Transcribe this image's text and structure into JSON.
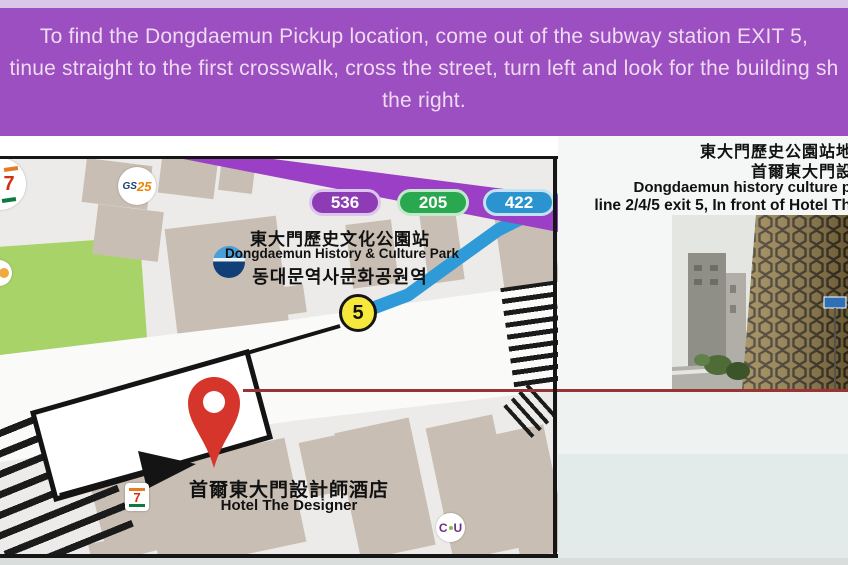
{
  "header": {
    "line1": "To find the Dongdaemun Pickup location, come out of the subway station EXIT 5,",
    "line2": "tinue straight to the first crosswalk, cross the street, turn left and look for the building sh",
    "line3": "the right."
  },
  "map": {
    "badges": [
      {
        "number": "536",
        "color": "#8e3cb5"
      },
      {
        "number": "205",
        "color": "#2aa84f"
      },
      {
        "number": "422",
        "color": "#2b93cf"
      }
    ],
    "station_zh": "東大門歷史文化公園站",
    "station_en": "Dongdaemun History & Culture Park",
    "station_ko": "동대문역사문화공원역",
    "exit_number": "5",
    "hotel_zh": "首爾東大門設計師酒店",
    "hotel_en": "Hotel The Designer",
    "logo_seven": "7",
    "logo_gs": "GS",
    "logo_25": "25",
    "logo_cu_c": "C",
    "logo_cu_u": "U"
  },
  "right_panel": {
    "line1": "東大門歷史公園站地",
    "line2": "首爾東大門設",
    "line3": "Dongdaemun history culture p",
    "line4": "line 2/4/5 exit 5, In front of Hotel Th"
  },
  "colors": {
    "header_bg": "#9c4fc1",
    "header_text": "#eedaf1",
    "road_purple": "#9b3fc6",
    "exit_yellow": "#f6e93c",
    "pin_red": "#d6352c",
    "connector_red": "#983434",
    "park_green": "#a8d368",
    "building_tan": "#c8beb3",
    "path_blue": "#2e9bd8"
  }
}
